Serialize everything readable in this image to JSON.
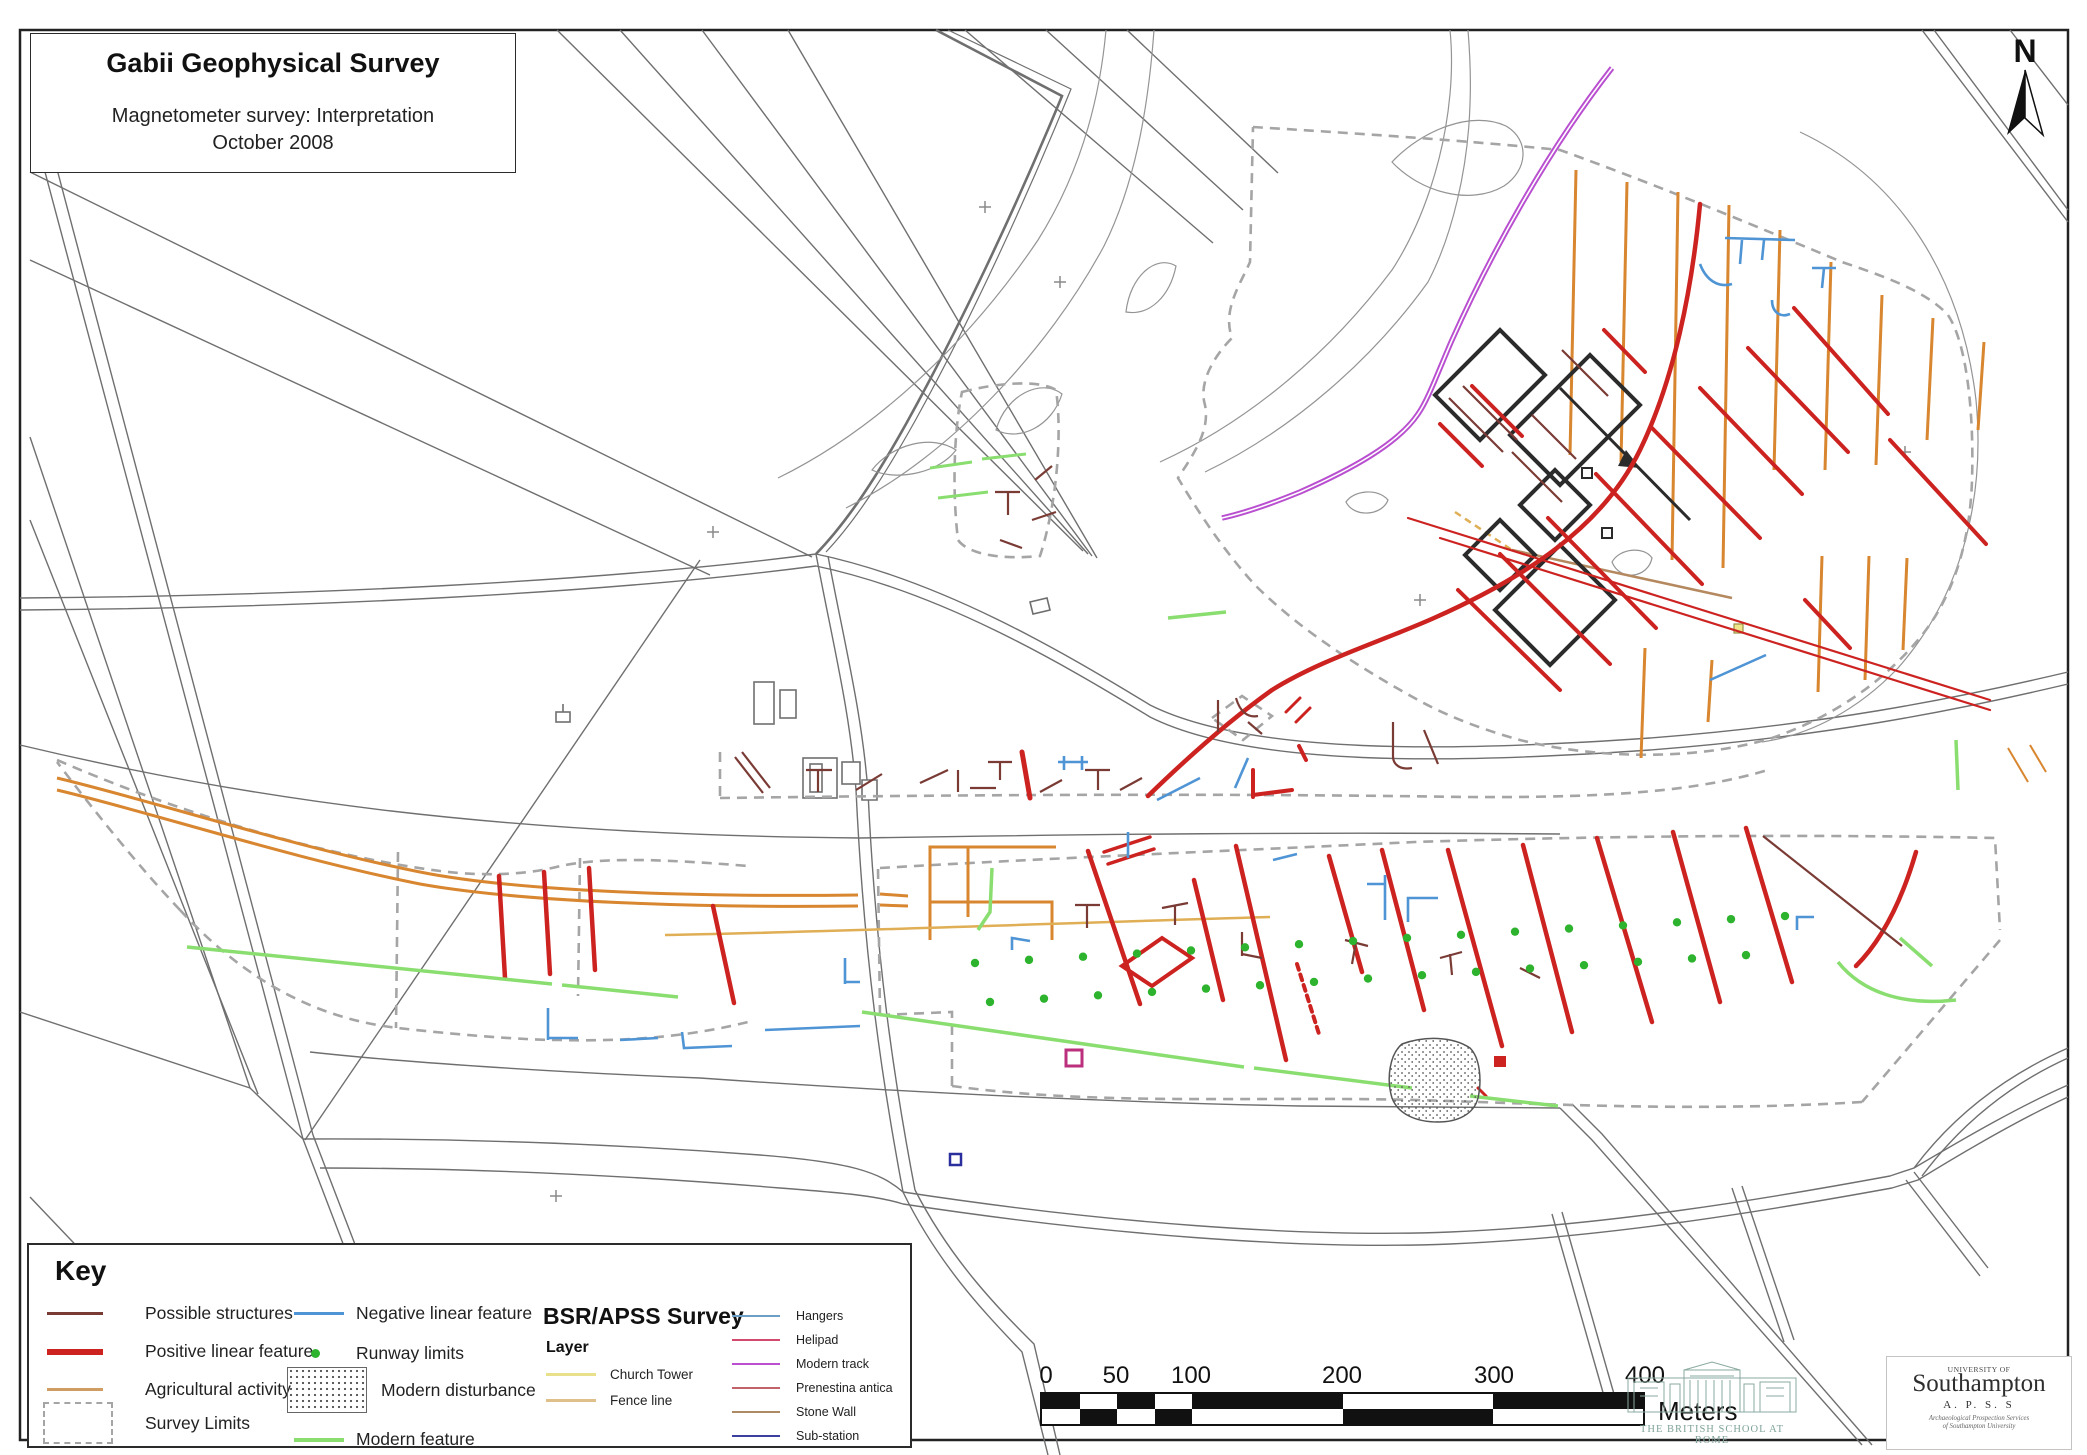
{
  "title_block": {
    "title": "Gabii Geophysical Survey",
    "subtitle": "Magnetometer survey: Interpretation",
    "date": "October 2008"
  },
  "north": {
    "label": "N"
  },
  "key": {
    "heading": "Key",
    "items": [
      {
        "label": "Possible structures",
        "color": "#7a3b35",
        "symbol": "thin-line"
      },
      {
        "label": "Positive linear feature",
        "color": "#cc2321",
        "symbol": "thick-line"
      },
      {
        "label": "Agricultural activity",
        "color": "#cf9d62",
        "symbol": "thin-line"
      },
      {
        "label": "Survey Limits",
        "color": "#a5a5a5",
        "symbol": "dashed-box"
      },
      {
        "label": "Negative linear feature",
        "color": "#4f94d4",
        "symbol": "thin-line"
      },
      {
        "label": "Runway limits",
        "color": "#2db32d",
        "symbol": "dot"
      },
      {
        "label": "Modern disturbance",
        "color": "#555555",
        "symbol": "stipple-box"
      },
      {
        "label": "Modern feature",
        "color": "#8ade70",
        "symbol": "thin-line"
      }
    ]
  },
  "bsr_survey": {
    "heading": "BSR/APSS Survey",
    "subheading": "Layer",
    "layers": [
      {
        "label": "Church Tower",
        "color": "#e8e08a"
      },
      {
        "label": "Fence line",
        "color": "#dfc08a"
      }
    ],
    "features": [
      {
        "label": "Hangers",
        "color": "#6d9ec6"
      },
      {
        "label": "Helipad",
        "color": "#d44a6e"
      },
      {
        "label": "Modern track",
        "color": "#bb4fd0"
      },
      {
        "label": "Prenestina antica",
        "color": "#c2626a"
      },
      {
        "label": "Stone Wall",
        "color": "#ad8a64"
      },
      {
        "label": "Sub-station",
        "color": "#3c3f9e"
      }
    ]
  },
  "scale_bar": {
    "ticks": [
      "0",
      "50",
      "100",
      "200",
      "300",
      "400"
    ],
    "unit": "Meters"
  },
  "logos": {
    "bsr": "THE BRITISH SCHOOL AT ROME",
    "southampton_pre": "UNIVERSITY OF",
    "southampton": "Southampton",
    "apss": "A. P. S. S",
    "apss_sub1": "Archaeological Prospection Services",
    "apss_sub2": "of Southampton University"
  },
  "palette": {
    "positive_feature": "#cc2321",
    "possible_structures": "#7a3b35",
    "agricultural": "#d8862f",
    "negative_feature": "#4f94d4",
    "modern_feature": "#8ade70",
    "runway_dot": "#2db32d",
    "survey_limit": "#a5a5a5",
    "modern_track": "#bb4fd0",
    "cadastral": "#6f6f6f"
  }
}
